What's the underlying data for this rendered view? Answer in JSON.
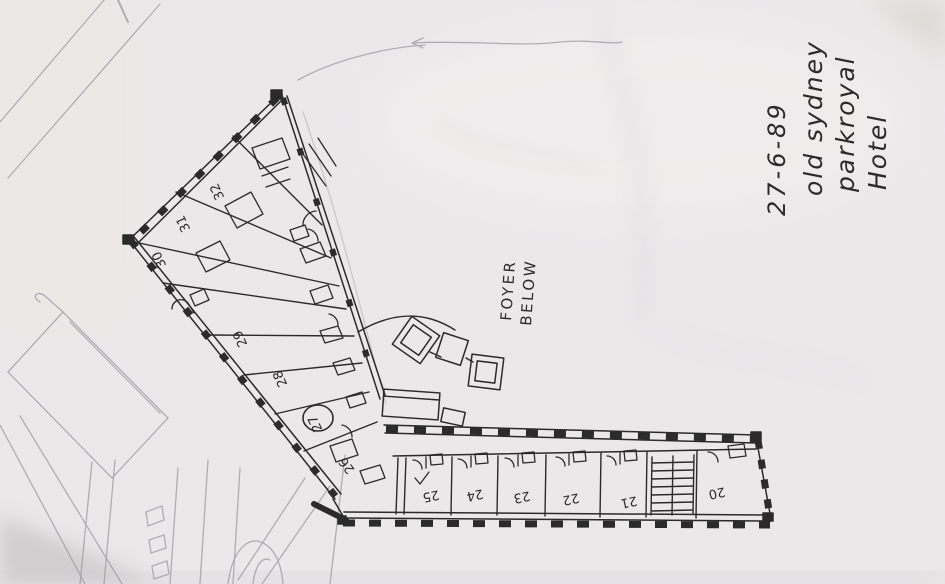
{
  "annotation": {
    "date": "27-6-89",
    "line1": "old sydney",
    "line2": "parkroyal",
    "line3": "Hotel"
  },
  "labels": {
    "foyer_line1": "FOYER",
    "foyer_line2": "BELOW"
  },
  "rooms": {
    "left_wing": [
      "32",
      "31",
      "30",
      "29",
      "28",
      "27",
      "26"
    ],
    "south_wing": [
      "25",
      "24",
      "23",
      "22",
      "21",
      "20"
    ],
    "circled_room": "27"
  },
  "colors": {
    "paper": "#eae8e9",
    "ink": "#2b2b2b",
    "pencil": "#8f8f98",
    "crease": "#d8d5da"
  }
}
